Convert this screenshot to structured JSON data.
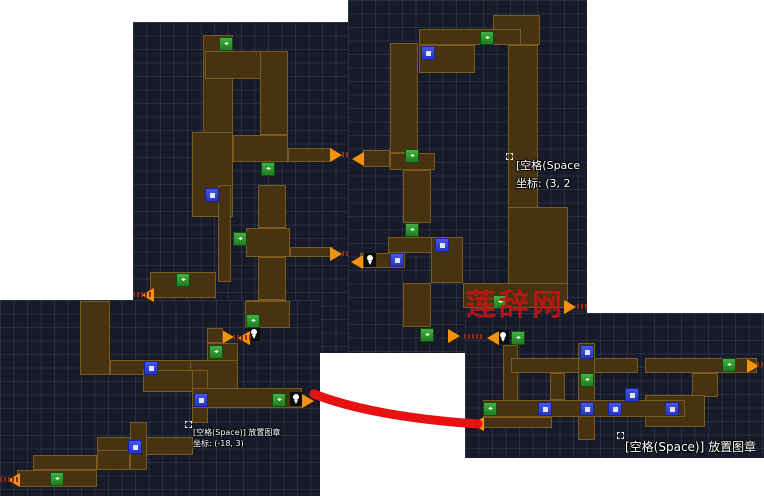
{
  "meta": {
    "width": 764,
    "height": 500,
    "background": "#ffffff"
  },
  "colors": {
    "panel_background": "#171b29",
    "grid_line": "#39466b",
    "corridor_fill": "#473211",
    "corridor_border": "#7b5a1e",
    "green_marker": "#2e9b2e",
    "blue_marker": "#3847d8",
    "orange_arrow": "#f5930f",
    "red_annotation": "#e81111",
    "watermark_red": "#c31515",
    "hint_text": "#ffffff"
  },
  "glyphs": {
    "green_marker": "◂▸"
  },
  "watermark": {
    "text": "莲辞网",
    "color": "#c31515"
  },
  "red_line": {
    "path": "M314,394 C360,412 420,420 478,424",
    "width": 9,
    "color": "#e81111"
  },
  "panels": [
    {
      "name": "top-left-map",
      "x": 133,
      "y": 22,
      "w": 215,
      "h": 331,
      "rects": [
        [
          203,
          35,
          30,
          100
        ],
        [
          205,
          51,
          83,
          28
        ],
        [
          260,
          51,
          28,
          84
        ],
        [
          192,
          132,
          41,
          85
        ],
        [
          233,
          135,
          55,
          27
        ],
        [
          288,
          148,
          44,
          14
        ],
        [
          218,
          185,
          13,
          97
        ],
        [
          258,
          185,
          28,
          43
        ],
        [
          246,
          228,
          44,
          29
        ],
        [
          290,
          247,
          43,
          10
        ],
        [
          258,
          257,
          28,
          43
        ],
        [
          246,
          300,
          40,
          28
        ],
        [
          150,
          272,
          66,
          26
        ],
        [
          208,
          328,
          15,
          27
        ]
      ],
      "icons": [
        {
          "t": "green",
          "x": 219,
          "y": 37
        },
        {
          "t": "green",
          "x": 261,
          "y": 162
        },
        {
          "t": "green",
          "x": 233,
          "y": 232
        },
        {
          "t": "green",
          "x": 176,
          "y": 273
        },
        {
          "t": "green",
          "x": 248,
          "y": 313
        },
        {
          "t": "green",
          "x": 210,
          "y": 345
        },
        {
          "t": "blue",
          "x": 205,
          "y": 188
        },
        {
          "t": "pin",
          "x": 248,
          "y": 327
        },
        {
          "t": "arrow-right",
          "x": 330,
          "y": 148
        },
        {
          "t": "arrow-right",
          "x": 330,
          "y": 247
        },
        {
          "t": "arrow-right",
          "x": 222,
          "y": 330
        },
        {
          "t": "arrow-left",
          "x": 142,
          "y": 288
        },
        {
          "t": "arrow-left",
          "x": 238,
          "y": 331
        },
        {
          "t": "marks",
          "x": 342,
          "y": 152
        },
        {
          "t": "marks",
          "x": 342,
          "y": 251
        },
        {
          "t": "marks",
          "x": 133,
          "y": 292
        },
        {
          "t": "marks",
          "x": 233,
          "y": 335
        }
      ],
      "texts": []
    },
    {
      "name": "top-right-map",
      "x": 348,
      "y": 0,
      "w": 239,
      "h": 353,
      "rects": [
        [
          493,
          15,
          47,
          30
        ],
        [
          419,
          29,
          102,
          16
        ],
        [
          419,
          45,
          56,
          28
        ],
        [
          508,
          45,
          30,
          165
        ],
        [
          390,
          43,
          28,
          110
        ],
        [
          363,
          150,
          27,
          17
        ],
        [
          390,
          153,
          45,
          17
        ],
        [
          403,
          170,
          28,
          53
        ],
        [
          388,
          237,
          75,
          16
        ],
        [
          360,
          253,
          45,
          15
        ],
        [
          431,
          237,
          32,
          46
        ],
        [
          508,
          207,
          60,
          78
        ],
        [
          463,
          283,
          105,
          25
        ],
        [
          403,
          283,
          28,
          44
        ]
      ],
      "icons": [
        {
          "t": "green",
          "x": 480,
          "y": 31
        },
        {
          "t": "green",
          "x": 405,
          "y": 149
        },
        {
          "t": "green",
          "x": 405,
          "y": 223
        },
        {
          "t": "green",
          "x": 493,
          "y": 295
        },
        {
          "t": "green",
          "x": 420,
          "y": 328
        },
        {
          "t": "blue",
          "x": 421,
          "y": 46
        },
        {
          "t": "blue",
          "x": 435,
          "y": 238
        },
        {
          "t": "blue",
          "x": 390,
          "y": 253
        },
        {
          "t": "pin",
          "x": 364,
          "y": 253
        },
        {
          "t": "arrow-left",
          "x": 352,
          "y": 152
        },
        {
          "t": "arrow-left",
          "x": 351,
          "y": 255
        },
        {
          "t": "arrow-right",
          "x": 564,
          "y": 300
        },
        {
          "t": "arrow-right",
          "x": 448,
          "y": 329
        },
        {
          "t": "marks",
          "x": 577,
          "y": 304
        },
        {
          "t": "marks",
          "x": 464,
          "y": 334
        },
        {
          "t": "cursor",
          "x": 506,
          "y": 153
        }
      ],
      "texts": [
        {
          "x": 516,
          "y": 157,
          "size": 11,
          "lh": 18,
          "lines": [
            "[空格(Space",
            "坐标: (3, 2"
          ]
        }
      ]
    },
    {
      "name": "bottom-left-map",
      "x": 0,
      "y": 300,
      "w": 320,
      "h": 196,
      "rects": [
        [
          80,
          301,
          30,
          74
        ],
        [
          245,
          301,
          45,
          27
        ],
        [
          207,
          328,
          16,
          15
        ],
        [
          207,
          343,
          31,
          18
        ],
        [
          110,
          360,
          97,
          15
        ],
        [
          190,
          360,
          48,
          31
        ],
        [
          143,
          370,
          50,
          22
        ],
        [
          192,
          370,
          16,
          53
        ],
        [
          192,
          388,
          110,
          20
        ],
        [
          97,
          437,
          96,
          18
        ],
        [
          130,
          422,
          17,
          48
        ],
        [
          97,
          450,
          33,
          20
        ],
        [
          33,
          455,
          64,
          15
        ],
        [
          17,
          470,
          80,
          17
        ]
      ],
      "icons": [
        {
          "t": "green",
          "x": 246,
          "y": 314
        },
        {
          "t": "green",
          "x": 209,
          "y": 345
        },
        {
          "t": "green",
          "x": 272,
          "y": 393
        },
        {
          "t": "green",
          "x": 50,
          "y": 472
        },
        {
          "t": "blue",
          "x": 144,
          "y": 361
        },
        {
          "t": "blue",
          "x": 194,
          "y": 393
        },
        {
          "t": "blue",
          "x": 128,
          "y": 440
        },
        {
          "t": "pin",
          "x": 290,
          "y": 392
        },
        {
          "t": "arrow-right",
          "x": 302,
          "y": 394
        },
        {
          "t": "arrow-left",
          "x": 8,
          "y": 473
        },
        {
          "t": "marks",
          "x": 0,
          "y": 477
        },
        {
          "t": "cursor",
          "x": 185,
          "y": 421
        }
      ],
      "texts": [
        {
          "x": 193,
          "y": 427,
          "size": 8,
          "lh": 11,
          "lines": [
            "[空格(Space)] 放置图章",
            "坐标: (-18, 3)"
          ]
        }
      ]
    },
    {
      "name": "bottom-right-map",
      "x": 465,
      "y": 313,
      "w": 299,
      "h": 145,
      "rects": [
        [
          503,
          345,
          15,
          62
        ],
        [
          511,
          358,
          127,
          15
        ],
        [
          578,
          343,
          17,
          17
        ],
        [
          578,
          358,
          17,
          82
        ],
        [
          645,
          358,
          112,
          15
        ],
        [
          692,
          373,
          26,
          24
        ],
        [
          645,
          395,
          60,
          32
        ],
        [
          483,
          400,
          202,
          17
        ],
        [
          483,
          417,
          69,
          11
        ],
        [
          550,
          373,
          15,
          27
        ]
      ],
      "icons": [
        {
          "t": "green",
          "x": 511,
          "y": 331
        },
        {
          "t": "green",
          "x": 580,
          "y": 373
        },
        {
          "t": "green",
          "x": 722,
          "y": 358
        },
        {
          "t": "green",
          "x": 483,
          "y": 402
        },
        {
          "t": "blue",
          "x": 580,
          "y": 345
        },
        {
          "t": "blue",
          "x": 625,
          "y": 388
        },
        {
          "t": "blue",
          "x": 538,
          "y": 402
        },
        {
          "t": "blue",
          "x": 580,
          "y": 402
        },
        {
          "t": "blue",
          "x": 608,
          "y": 402
        },
        {
          "t": "blue",
          "x": 665,
          "y": 402
        },
        {
          "t": "pin",
          "x": 497,
          "y": 330
        },
        {
          "t": "arrow-left",
          "x": 487,
          "y": 331
        },
        {
          "t": "arrow-left",
          "x": 472,
          "y": 417
        },
        {
          "t": "arrow-right",
          "x": 747,
          "y": 359
        },
        {
          "t": "marks",
          "x": 757,
          "y": 362
        },
        {
          "t": "cursor",
          "x": 617,
          "y": 432
        }
      ],
      "texts": [
        {
          "x": 625,
          "y": 440,
          "size": 12,
          "lh": 14,
          "lines": [
            "[空格(Space)] 放置图章"
          ]
        }
      ]
    }
  ]
}
